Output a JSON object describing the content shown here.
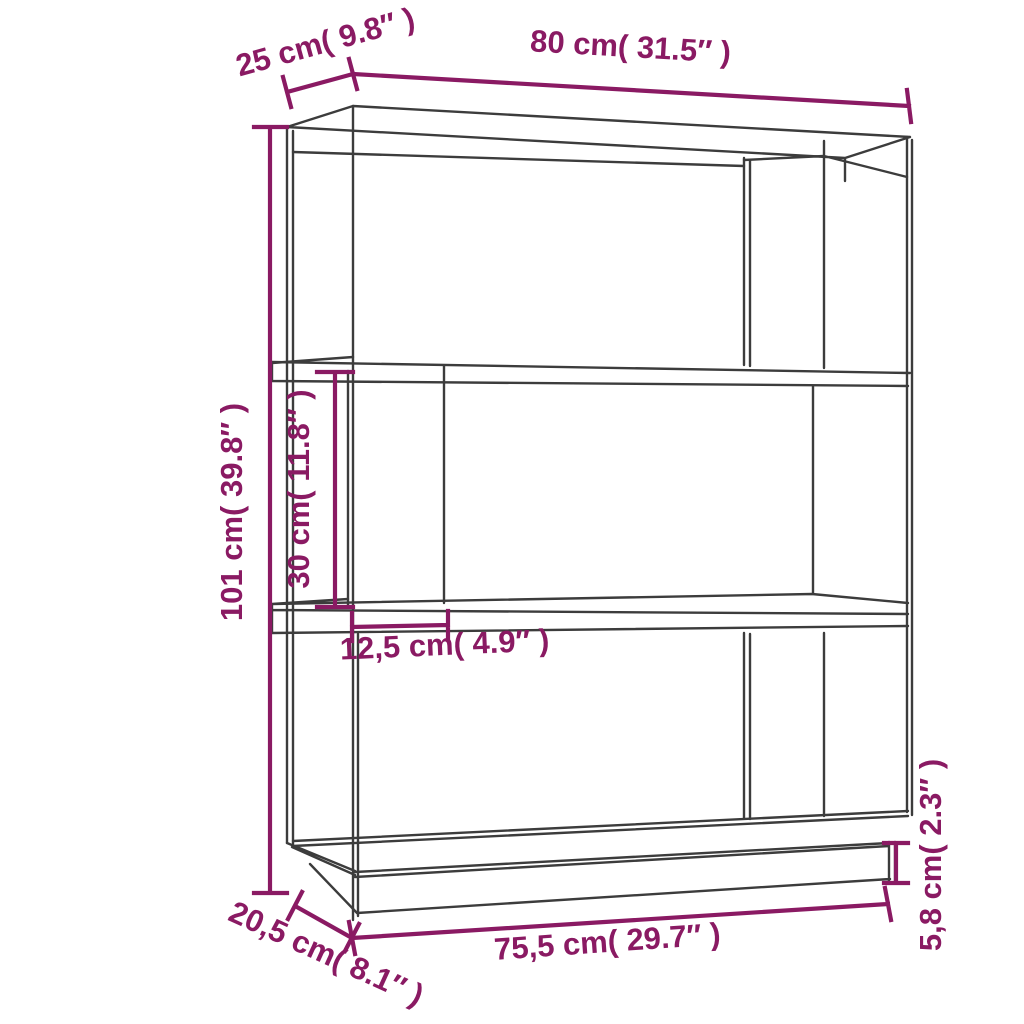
{
  "diagram": {
    "type": "furniture-dimension-drawing",
    "background_color": "#ffffff",
    "line_color": "#3c3c3c",
    "dimension_color": "#8a1a63",
    "dimensions": {
      "depth_top": "25 cm( 9.8″ )",
      "width_top": "80 cm( 31.5″ )",
      "height_total": "101 cm( 39.8″ )",
      "shelf_opening_height": "30 cm( 11.8″ )",
      "divider_inset": "12,5 cm( 4.9″ )",
      "width_bottom": "75,5 cm( 29.7″ )",
      "depth_bottom": "20,5 cm( 8.1″ )",
      "plinth_height": "5,8 cm( 2.3″ )"
    }
  }
}
